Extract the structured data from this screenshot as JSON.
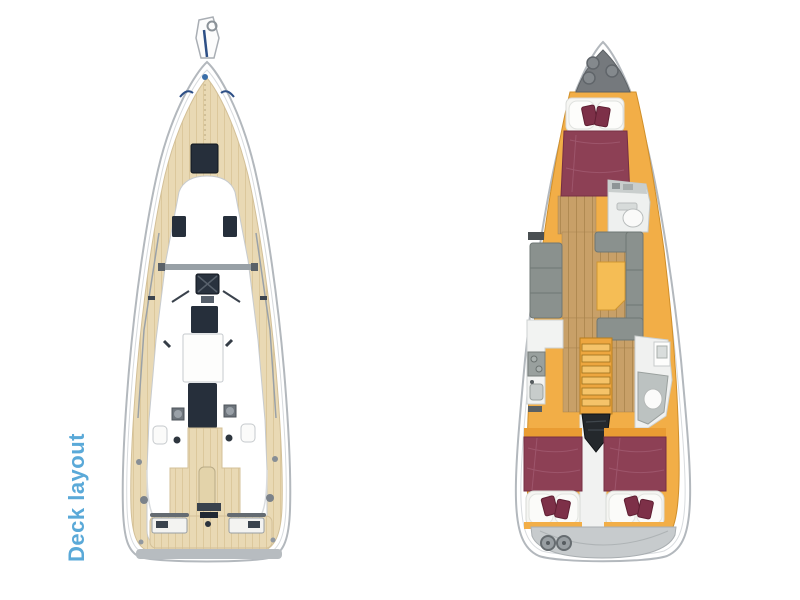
{
  "figures": {
    "deck": {
      "label": "Deck layout"
    },
    "cabins": {
      "label": "3 cabin layout"
    }
  },
  "colors": {
    "label_blue": "#5aa9d8",
    "hull_outline": "#b3b8bd",
    "teak_deck": "#e9d9b4",
    "hatch_dark": "#262f3b",
    "furniture_orange": "#f2ae47",
    "upholstery_maroon": "#8d4055",
    "cushion_maroon": "#7d3048",
    "floor_wood": "#c8a068",
    "sofa_gray": "#8a918e",
    "locker_gray": "#75797d",
    "engine_black": "#24282c",
    "steps_yellow": "#eda63f"
  }
}
